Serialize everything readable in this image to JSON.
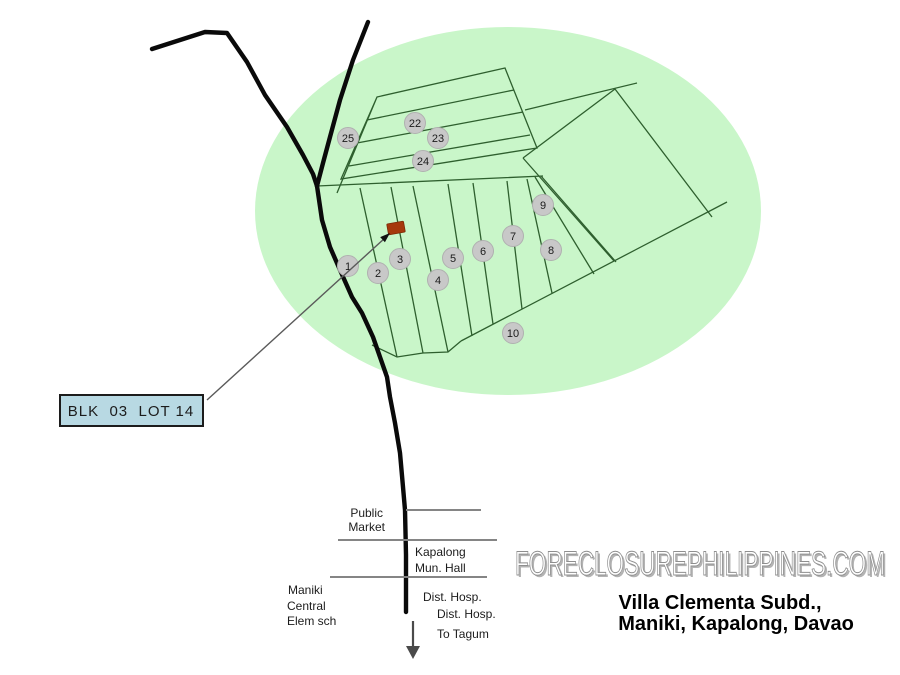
{
  "title": {
    "line1": "Villa Clementa Subd.,",
    "line2": "Maniki, Kapalong, Davao"
  },
  "watermark": "FORECLOSUREPHILIPPINES.COM",
  "callout": {
    "text": "BLK  03  LOT 14"
  },
  "landmarks": {
    "public_market": [
      "Public",
      "Market"
    ],
    "mun_hall": [
      "Kapalong",
      "Mun. Hall"
    ],
    "elem_school": [
      "Maniki",
      "Central",
      "Elem sch"
    ],
    "hospital_1": "Dist. Hosp.",
    "hospital_2": "Dist. Hosp.",
    "to_tagum": "To Tagum"
  },
  "block_markers": [
    {
      "label": "1"
    },
    {
      "label": "2"
    },
    {
      "label": "3"
    },
    {
      "label": "4"
    },
    {
      "label": "5"
    },
    {
      "label": "6"
    },
    {
      "label": "7"
    },
    {
      "label": "8"
    },
    {
      "label": "9"
    },
    {
      "label": "10"
    },
    {
      "label": "22"
    },
    {
      "label": "23"
    },
    {
      "label": "24"
    },
    {
      "label": "25"
    }
  ],
  "colors": {
    "area": "#c9f6c9",
    "lot_line": "#2e5f2e",
    "road": "#0a0a0a",
    "marker_fill": "#c8c8c8",
    "subject_marker": "#a6380c",
    "callout_fill": "#b8d9e3"
  }
}
